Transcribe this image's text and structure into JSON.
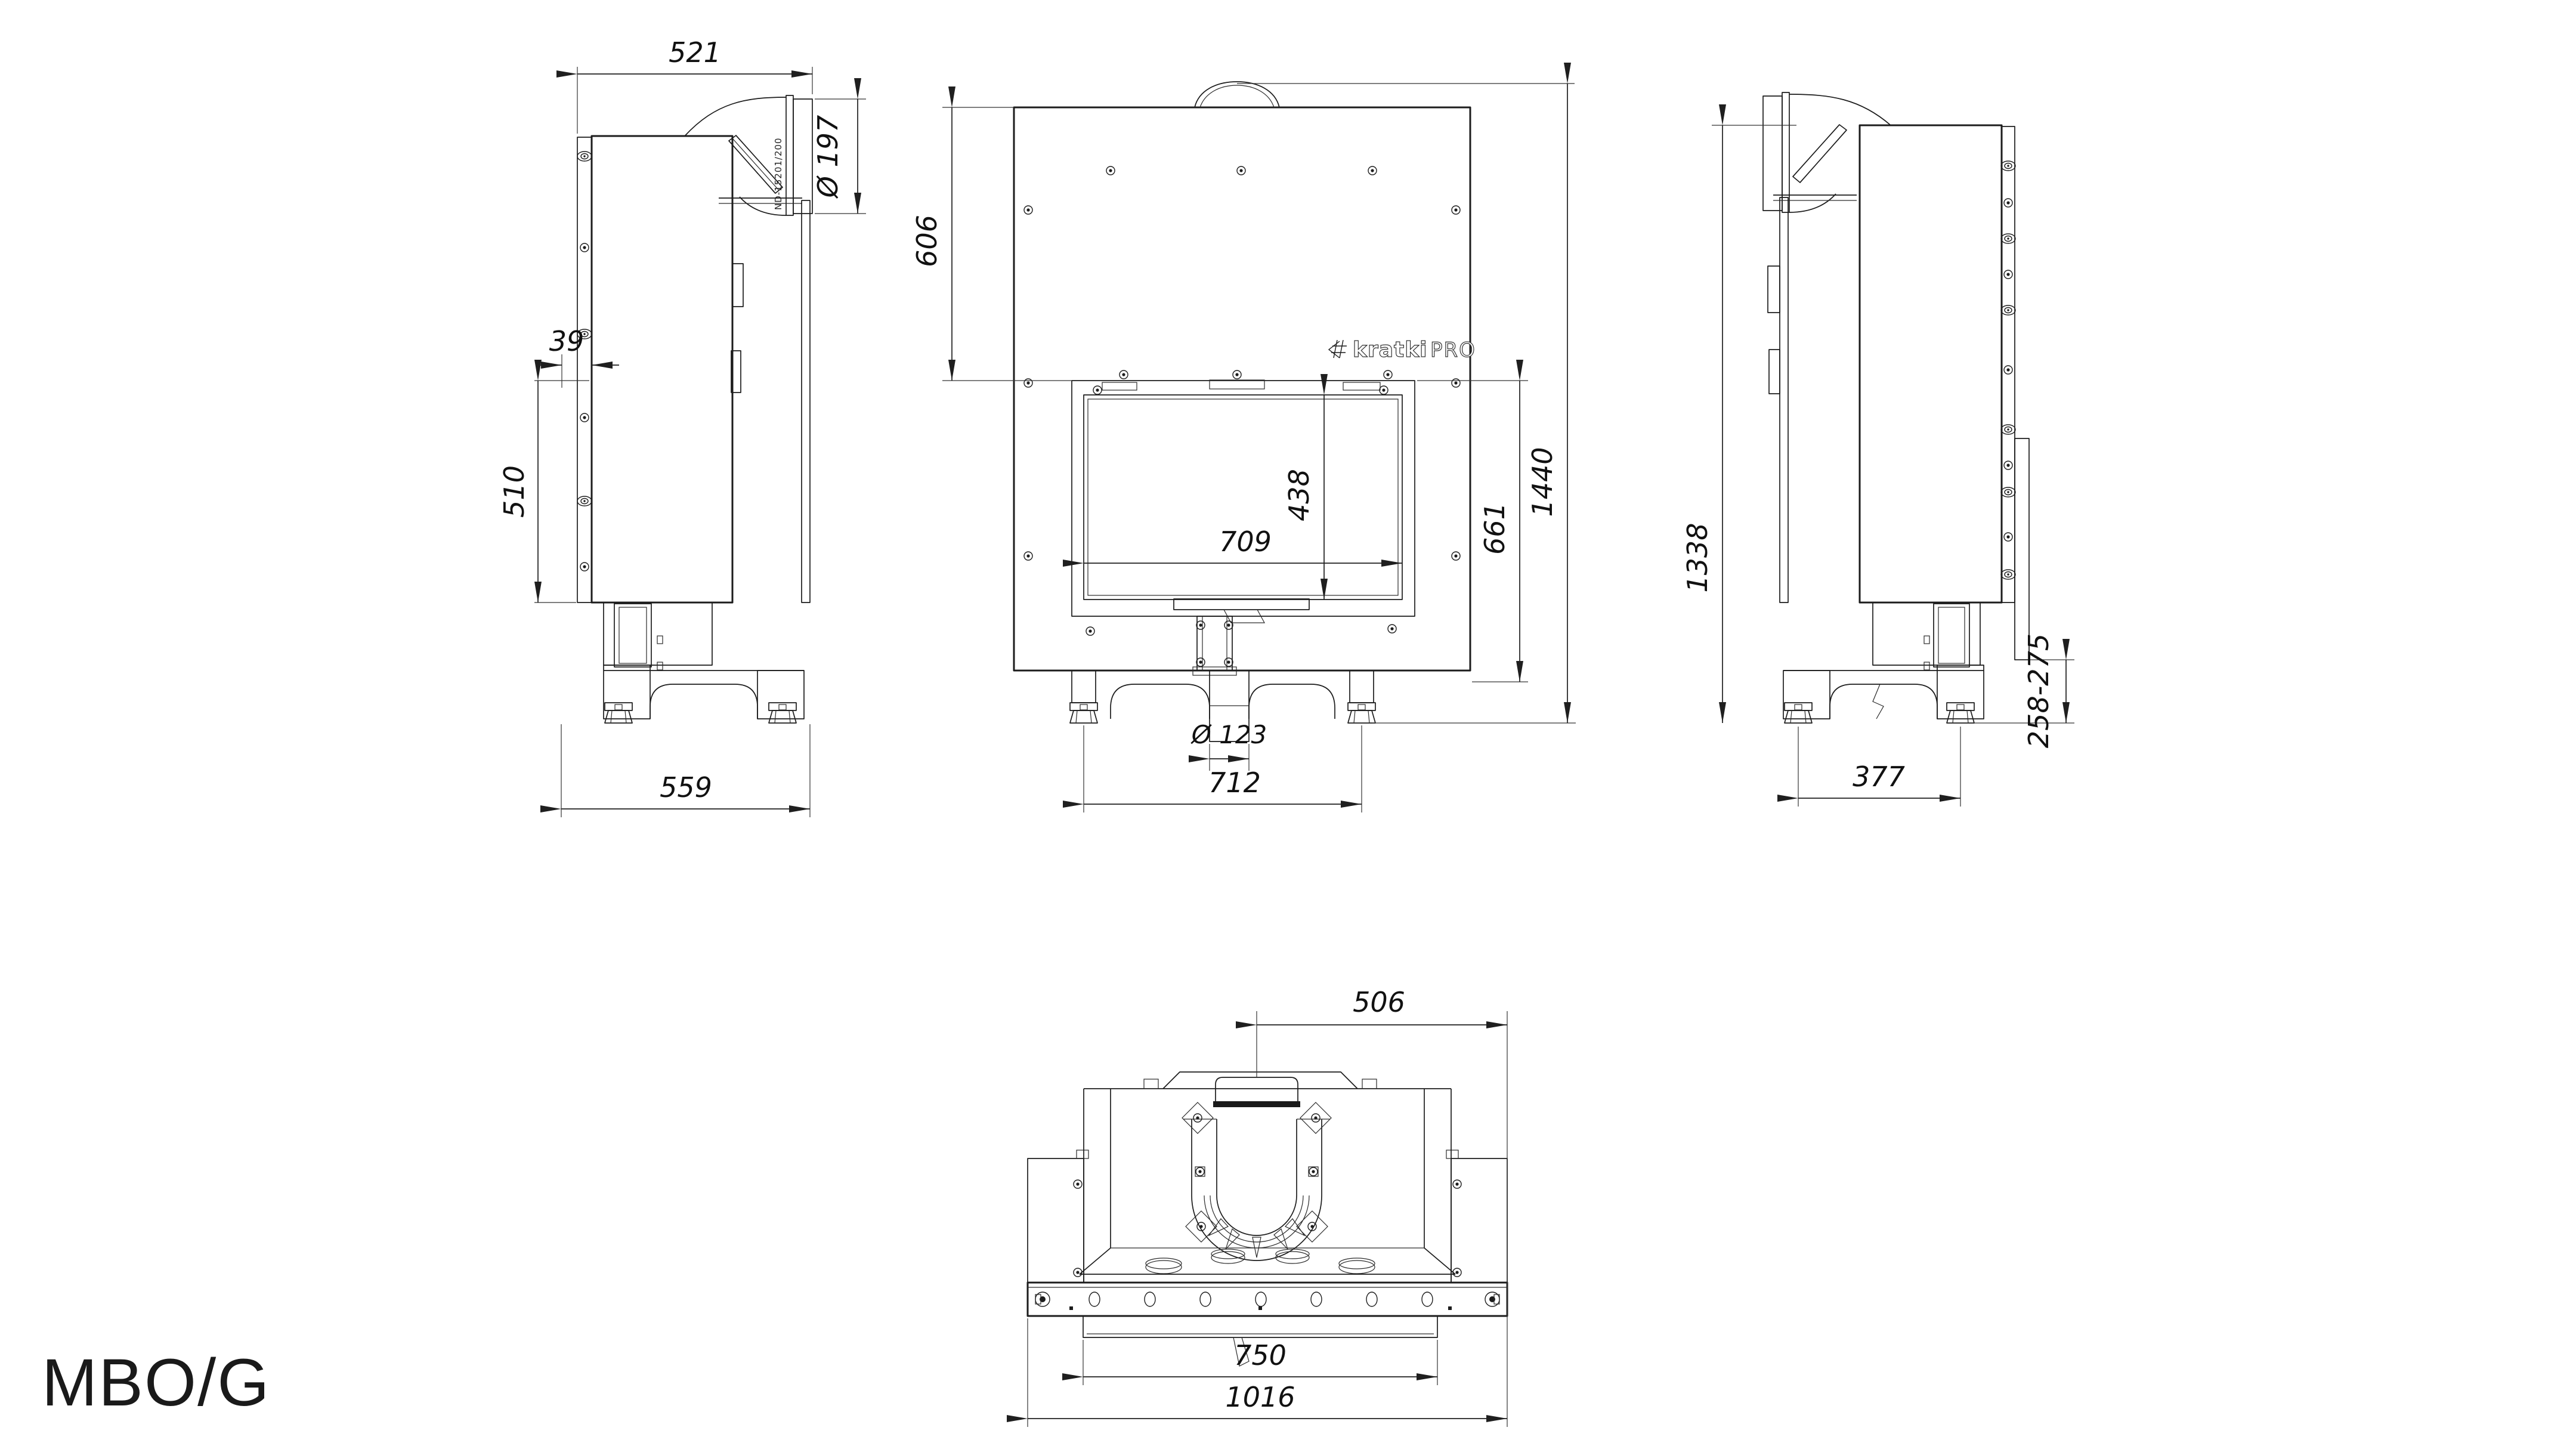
{
  "title": "MBO/G",
  "logo": {
    "brand": "kratki",
    "suffix": "PRO"
  },
  "duct_part_label": "ND-15201/200",
  "views": {
    "side_left": {
      "dims": {
        "top_depth": "521",
        "flue_diameter": "Ø 197",
        "frame_offset": "39",
        "frame_height": "510",
        "base_depth": "559"
      }
    },
    "front": {
      "dims": {
        "top_to_glass": "606",
        "glass_height": "438",
        "glass_width": "709",
        "front_height": "661",
        "total_height": "1440",
        "intake_diameter": "Ø 123",
        "feet_spacing": "712"
      }
    },
    "side_right": {
      "dims": {
        "body_height": "1338",
        "base_height_range": "258-275",
        "feet_spacing": "377"
      }
    },
    "bottom": {
      "dims": {
        "flue_offset": "506",
        "inner_width": "750",
        "total_width": "1016"
      }
    }
  }
}
